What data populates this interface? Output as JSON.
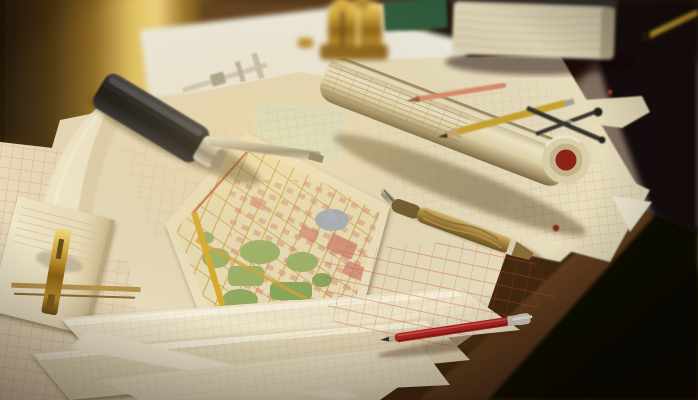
{
  "meta": {
    "type": "photograph",
    "subject": "Warmly lit architect's desk covered with vintage city maps, blueprint sheets and drafting tools",
    "lighting": "golden window light from upper left, dark vignette lower right"
  },
  "colors": {
    "desk_wood": "#42280f",
    "desk_sheen": "#8e7e70",
    "desk_edge_light": "#7c4e29",
    "desk_dark_corner": "#0f0a05",
    "bg_glow": "#eed37e",
    "paper_cream": "#e6dabb",
    "paper_light": "#f1e8d0",
    "map_base": "#e9ddb6",
    "map_road_yellow": "#c7a24a",
    "map_border_yellow": "#d9ab2e",
    "map_park_green": "#9cb269",
    "map_block_pink": "#d2897b",
    "map_water_blue": "#9aa6bf",
    "map_line_pink": "#cf8676",
    "plan_line_sepia": "#a99266",
    "plan_line_red": "#c05038",
    "roll_paper": "#efe6c7",
    "roll_cap_red": "#8c2318",
    "tool_black": "#17171b",
    "metal_silver": "#c9c4b6",
    "brass": "#c89b33",
    "pen_red": "#b32622",
    "pencil_yellow": "#c9a32e",
    "pencil_salmon": "#d98a6a",
    "book_pages": "#dbd1b2",
    "notebook_green": "#2d5a3b"
  },
  "objects": [
    {
      "name": "window-light",
      "note": "blurred golden light band, upper left background"
    },
    {
      "name": "desk",
      "note": "dark brown wooden drafting desk with rounded front edge"
    },
    {
      "name": "city-map",
      "note": "large antique street map, yellow border, green parks, pink blocks, blue patch"
    },
    {
      "name": "blueprint-roll",
      "note": "rolled plan tube with printed ledger grid and dark red capped end"
    },
    {
      "name": "black-handle-tool",
      "note": "black-handled marking gauge with steel blade ruler"
    },
    {
      "name": "caliper",
      "note": "steel sliding caliper above the black tool"
    },
    {
      "name": "steel-ruler",
      "note": "thin steel blade extending toward the map"
    },
    {
      "name": "notepad",
      "note": "cream pad at left with brass beam instrument resting on it"
    },
    {
      "name": "brass-clip",
      "note": "cross-shaped brass drafting instrument on the notepad"
    },
    {
      "name": "fountain-pen",
      "note": "vintage brass marbled fountain pen, nib pointing upper-left"
    },
    {
      "name": "red-ballpoint-pen",
      "note": "red pen with silver clip near desk front edge"
    },
    {
      "name": "yellow-pencil",
      "note": "yellow pencil lying across the blueprint roll"
    },
    {
      "name": "salmon-pencil",
      "note": "salmon/orange pencil above the roll"
    },
    {
      "name": "drafting-compass",
      "note": "dark steel divider compass right of the pencils"
    },
    {
      "name": "book",
      "note": "thick book with cream page block, top right"
    },
    {
      "name": "green-notebook",
      "note": "dark green notebook behind the brass ornament"
    },
    {
      "name": "brass-ornament",
      "note": "ornate golden object, blurred, top center"
    },
    {
      "name": "corner-pencil",
      "note": "yellow pencil in dark top right corner"
    },
    {
      "name": "torn-paper",
      "note": "small torn paper scrap on right desk area"
    },
    {
      "name": "paper-sheets",
      "note": "fanned overlapping plan sheets with faint sepia and pink linework"
    }
  ]
}
